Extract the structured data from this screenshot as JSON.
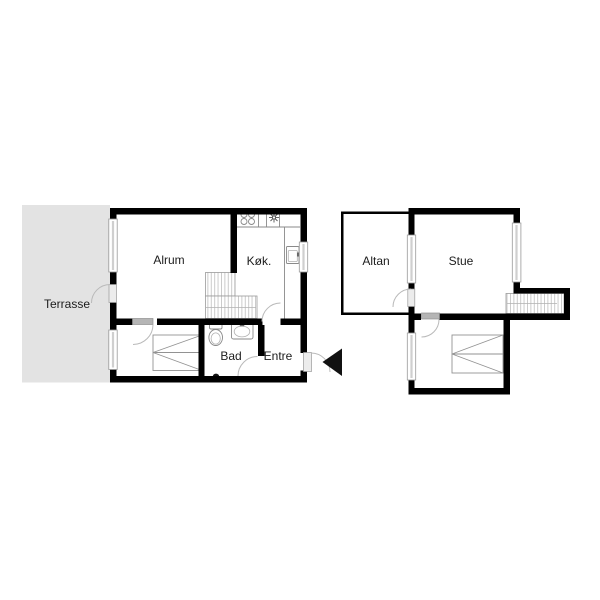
{
  "rooms": {
    "terrasse": "Terrasse",
    "alrum": "Alrum",
    "kok": "Køk.",
    "bad": "Bad",
    "entre": "Entre",
    "altan": "Altan",
    "stue": "Stue"
  },
  "colors": {
    "background": "#ffffff",
    "wall": "#000000",
    "terrace_fill": "#e3e3e3",
    "window_frame": "#9a9a9a",
    "window_glass": "#cfcfcf",
    "door_arc": "#b9b9b9",
    "door_panel": "#b5b5b5",
    "fixture_line": "#8a8a8a",
    "tread_line": "#c6c6c6",
    "label_text": "#1c1c1c",
    "arrow": "#111111"
  }
}
